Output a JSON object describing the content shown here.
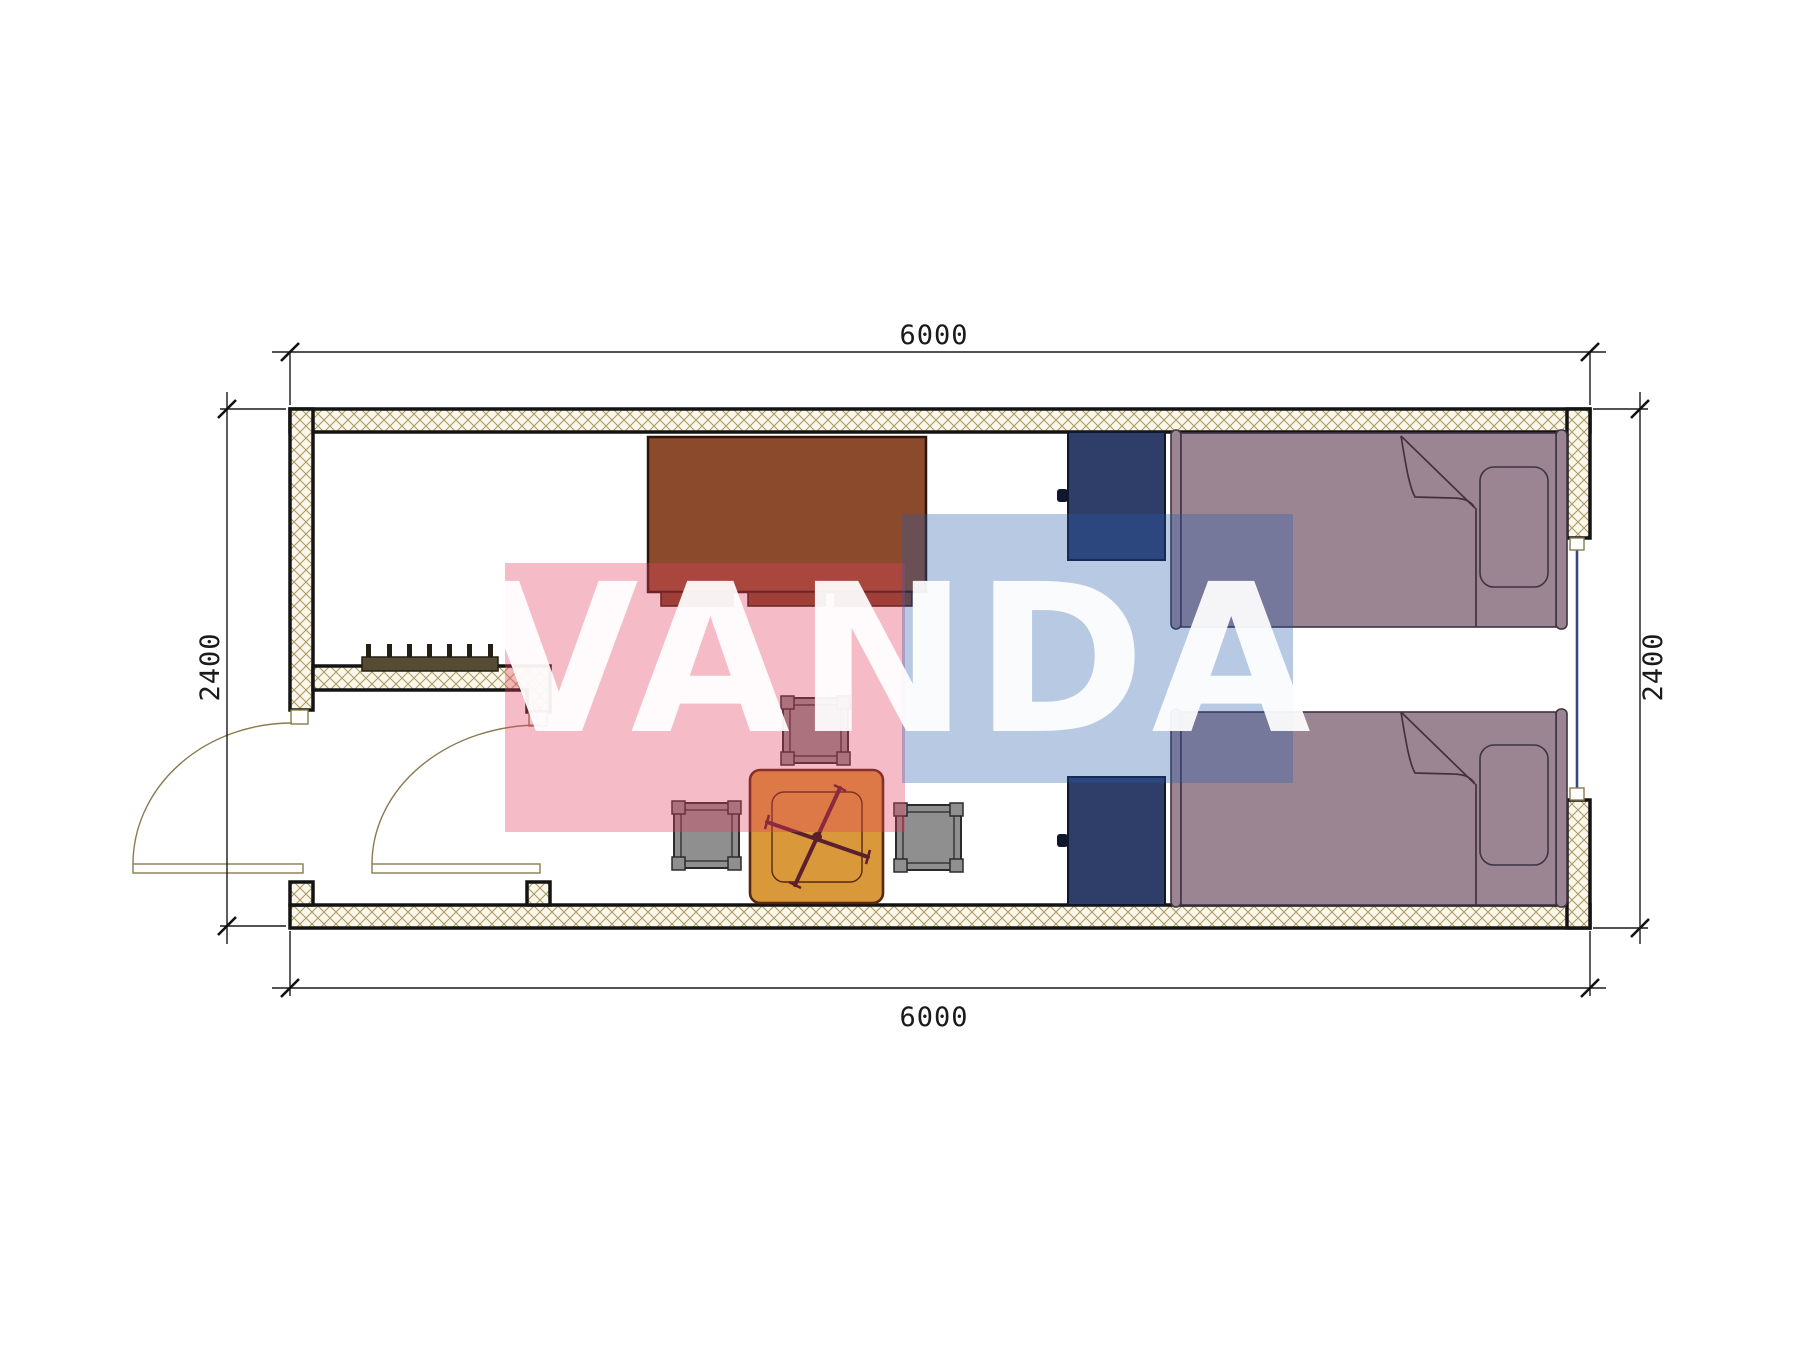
{
  "drawing": {
    "type": "architectural-floor-plan",
    "module_size_mm": "6000 x 2400",
    "dimensions": {
      "top": "6000",
      "bottom": "6000",
      "left": "2400",
      "right": "2400"
    },
    "watermark": {
      "text": "VANDA",
      "pink_hex": "#e23e5e",
      "blue_hex": "#285cac"
    },
    "colors": {
      "outline": "#141414",
      "wall_fill": "#faf6ea",
      "hatch_line": "#a8975f",
      "desk": "#8b4a2b",
      "desk_dark": "#7c4023",
      "nightstand": "#2e3e68",
      "bed": "#9c8593",
      "table": "#d9983a",
      "cross": "#5c1f2e",
      "stool": "#8f8f8f",
      "radiator": "#564b33",
      "glass": "#35477f",
      "doorline": "#8a7a50",
      "wm_pink_rgba": "rgba(226,62,94,0.35)",
      "wm_blue_rgba": "rgba(40,92,172,0.33)"
    },
    "furniture": [
      "desk",
      "nightstand-top",
      "nightstand-bottom",
      "single-bed-top",
      "single-bed-bottom",
      "square-table",
      "stool-top",
      "stool-left",
      "stool-right",
      "radiator",
      "entry-door-left",
      "entry-door-inner",
      "window-right"
    ]
  }
}
